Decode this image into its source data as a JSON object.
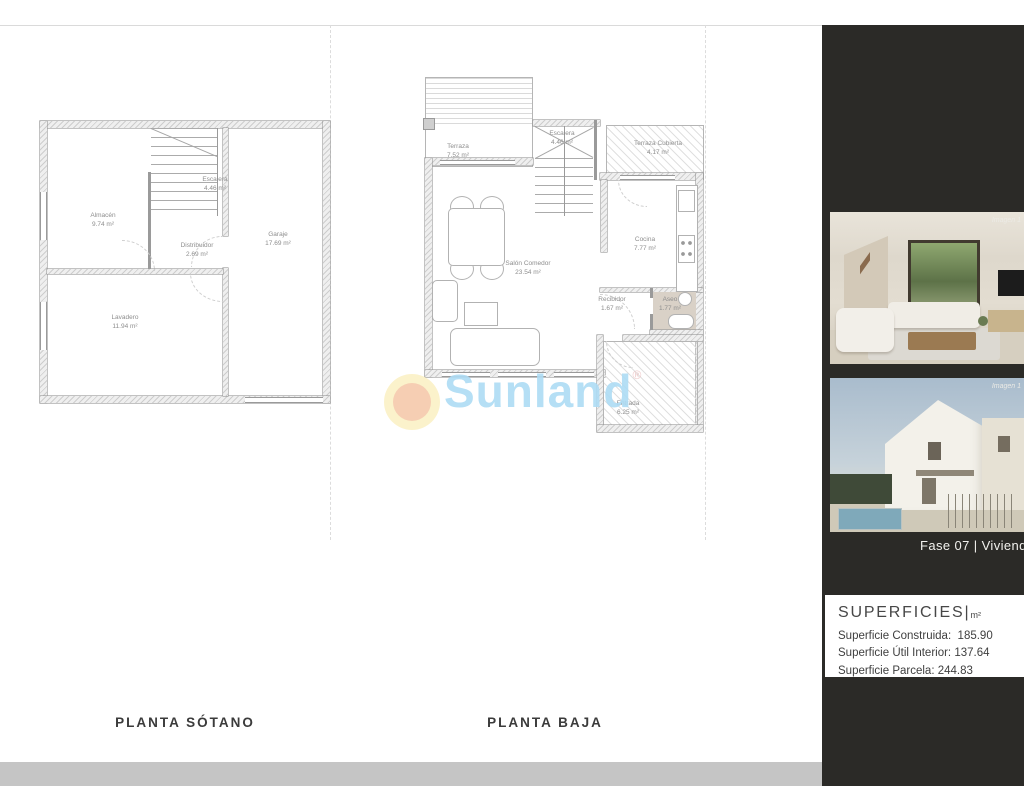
{
  "page": {
    "bg": "#ffffff",
    "footer_bar_color": "#c5c5c5",
    "rule_color": "#dadada"
  },
  "watermark": {
    "text": "Sunland",
    "registered": "®",
    "text_color": "#aedcf4",
    "circle_outer": "#fbf1c6",
    "circle_inner": "#f6c9ab"
  },
  "plans": [
    {
      "title": "PLANTA SÓTANO",
      "rooms": [
        {
          "name": "Almacén",
          "area": "9.74 m²"
        },
        {
          "name": "Escalera",
          "area": "4.46 m²"
        },
        {
          "name": "Distribuidor",
          "area": "2.69 m²"
        },
        {
          "name": "Garaje",
          "area": "17.69 m²"
        },
        {
          "name": "Lavadero",
          "area": "11.94 m²"
        }
      ]
    },
    {
      "title": "PLANTA BAJA",
      "rooms": [
        {
          "name": "Terraza",
          "area": "7.52 m²"
        },
        {
          "name": "Escalera",
          "area": "4.46 m²"
        },
        {
          "name": "Terraza Cubierta",
          "area": "4.17 m²"
        },
        {
          "name": "Salón Comedor",
          "area": "23.54 m²"
        },
        {
          "name": "Cocina",
          "area": "7.77 m²"
        },
        {
          "name": "Recibidor",
          "area": "1.67 m²"
        },
        {
          "name": "Aseo",
          "area": "1.77 m²"
        },
        {
          "name": "Entrada",
          "area": "6.25 m²"
        }
      ]
    }
  ],
  "sidebar": {
    "bg": "#2b2a27",
    "phase_label": "Fase 07 |  Vivienda",
    "images": [
      {
        "label": "Imagen 1"
      },
      {
        "label": "Imagen 1"
      }
    ],
    "superficies": {
      "title": "SUPERFICIES",
      "divider": "|",
      "unit": "m²",
      "rows": [
        {
          "label": "Superficie Construida:",
          "value": "185.90"
        },
        {
          "label": "Superficie Útil Interior:",
          "value": "137.64"
        },
        {
          "label": "Superficie Parcela:",
          "value": "244.83"
        }
      ]
    }
  }
}
